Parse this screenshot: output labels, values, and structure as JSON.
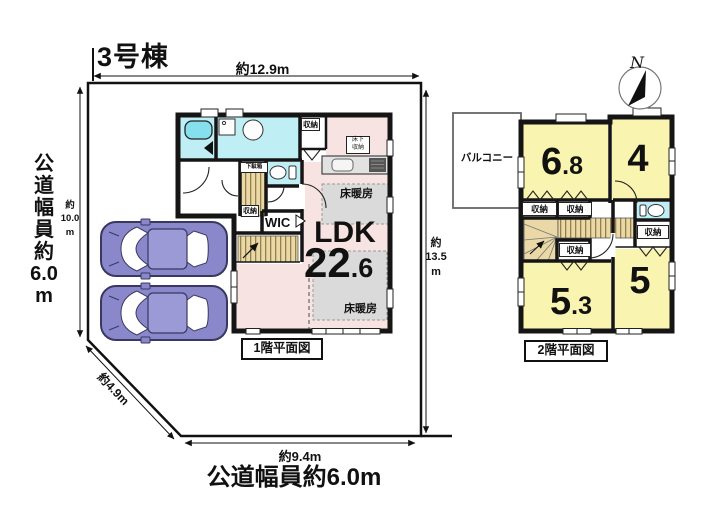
{
  "title": "3号棟",
  "site": {
    "dim_top": "約12.9m",
    "dim_left": "約\n10.0\nm",
    "road_left": "公\n道\n幅\n員\n約\n6.0\nm",
    "dim_right": "約\n13.5\nm",
    "dim_diagonal": "約4.9m",
    "dim_bottom": "約9.4m",
    "road_bottom": "公道幅員約6.0m"
  },
  "floor1": {
    "caption": "1階平面図",
    "ldk_label": "LDK",
    "ldk_size_int": "22",
    "ldk_size_dec": ".6",
    "wic": "WIC",
    "closet_top": "収納",
    "closet_entry": "収納",
    "shoe_cabinet": "下駄箱",
    "underfloor_storage": "床下\n収納",
    "floor_heating_upper": "床暖房",
    "floor_heating_lower": "床暖房"
  },
  "floor2": {
    "caption": "2階平面図",
    "balcony": "バルコニー",
    "room_68_int": "6",
    "room_68_dec": ".8",
    "room_4": "4",
    "room_53_int": "5",
    "room_53_dec": ".3",
    "room_5": "5",
    "closet_a": "収納",
    "closet_b": "収納",
    "closet_c": "収納",
    "closet_d": "収納"
  },
  "compass": {
    "north": "N"
  },
  "colors": {
    "wall": "#151515",
    "ldk_pink": "#f8e3e3",
    "room_yellow": "#f9f5b0",
    "wet_cyan": "#bfeef4",
    "tub_cyan": "#86dfec",
    "entry_beige": "#ead9a6",
    "floor_heating_gray": "#dadada",
    "car_purple": "#8a88cb"
  }
}
